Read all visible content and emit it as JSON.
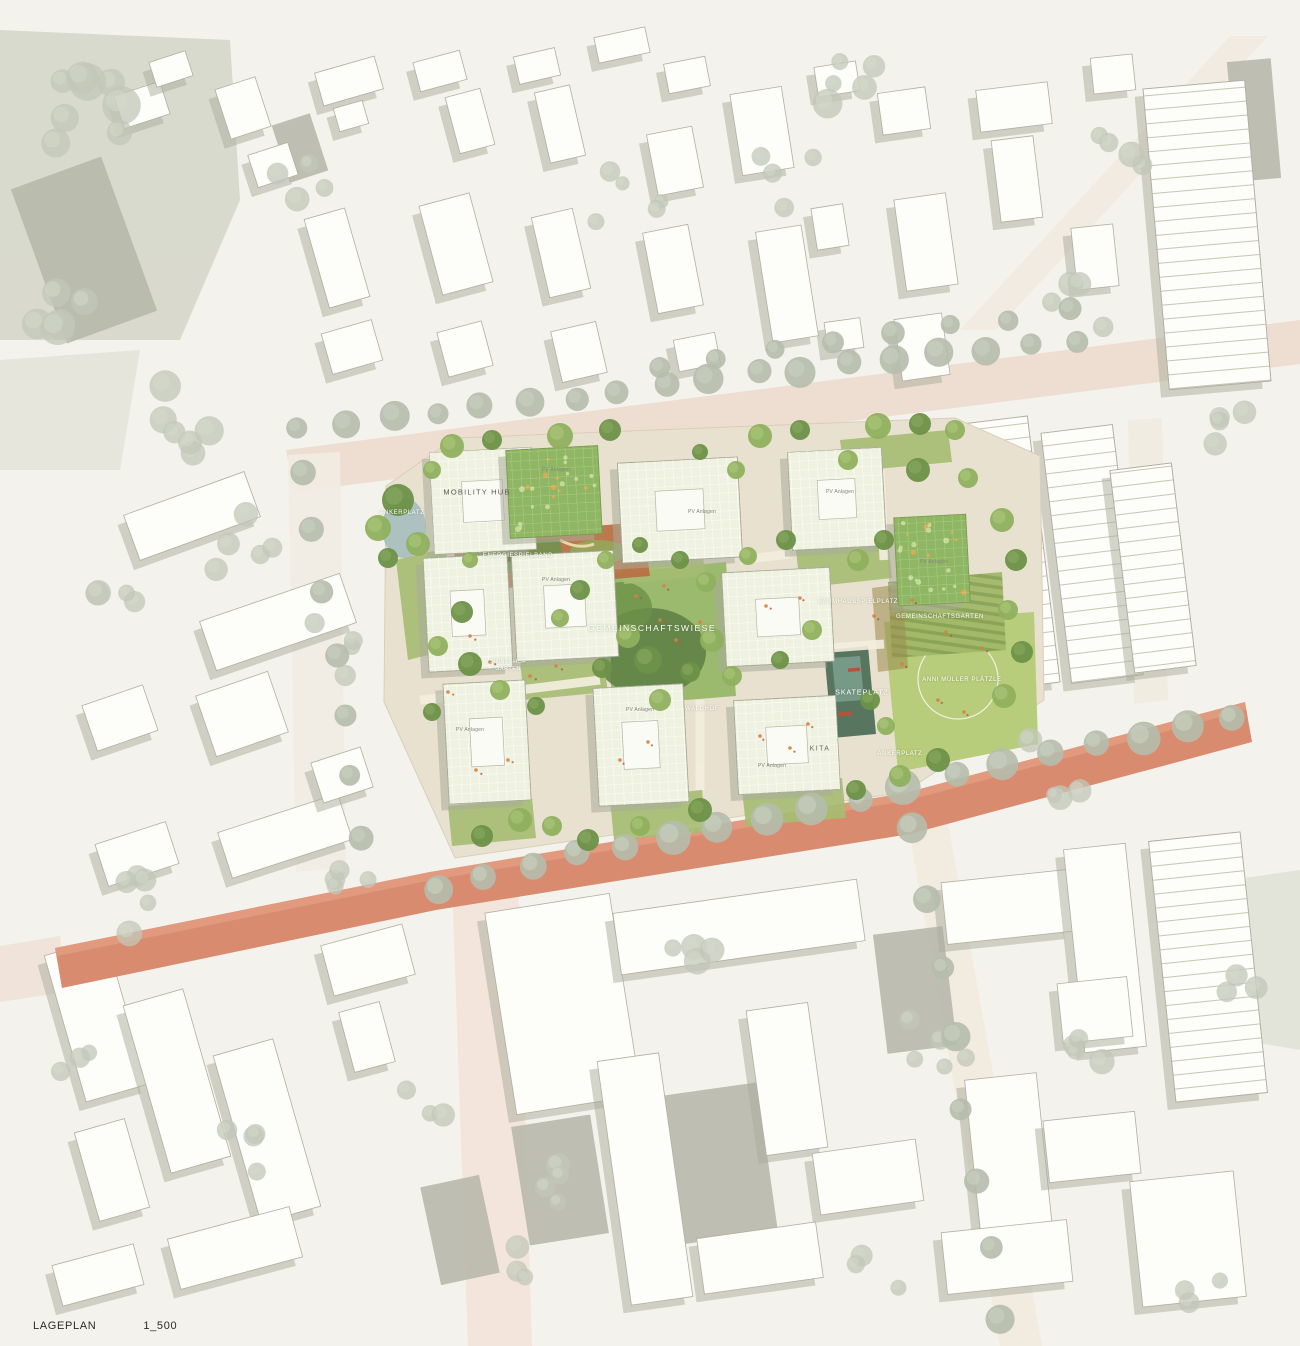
{
  "meta": {
    "title_label": "LAGEPLAN",
    "scale_label": "1_500"
  },
  "colors": {
    "background": "#f4f2ec",
    "context_building": "#fdfdf9",
    "context_shadow": "#a9ab9b",
    "main_street_salmon": "#d98b6f",
    "top_road_pink": "#ecd9cc",
    "site_base_tan": "#e9e1cf",
    "meadow_green": "#9cba6e",
    "lawn_green": "#b7cd7b",
    "dark_grove_green": "#5e7f46",
    "pv_roof_green": "#eff2e1",
    "garden_roof_green": "#8fb763",
    "play_band_orange": "#b96f42",
    "skate_teal": "#57755f",
    "label_white": "#ffffff",
    "caption_black": "#2b2b28"
  },
  "site_labels": [
    {
      "name": "label-ankerplatz-west",
      "text": "ANKERPLATZ",
      "x": 402,
      "y": 513,
      "variant": "small"
    },
    {
      "name": "label-mobility-hub",
      "text": "MOBILITY HUB",
      "x": 477,
      "y": 492,
      "variant": "dark"
    },
    {
      "name": "label-energiespielband",
      "text": "ENERGIESPIELBAND",
      "x": 518,
      "y": 556,
      "variant": "small"
    },
    {
      "name": "label-sinneshof-garten",
      "text": "SINNESHOF GARTEN",
      "x": 508,
      "y": 666,
      "variant": "tiny"
    },
    {
      "name": "label-gemeinschaftswiese",
      "text": "GEMEINSCHAFTSWIESE",
      "x": 652,
      "y": 628,
      "variant": "big"
    },
    {
      "name": "label-baumhausspielplatz",
      "text": "BAUMHAUSSPIELPLATZ",
      "x": 858,
      "y": 602,
      "variant": "small"
    },
    {
      "name": "label-gemeinschaftsgarten",
      "text": "GEMEINSCHAFTSGARTEN",
      "x": 940,
      "y": 617,
      "variant": "small"
    },
    {
      "name": "label-skateplatz",
      "text": "SKATEPLATZ",
      "x": 862,
      "y": 693,
      "variant": ""
    },
    {
      "name": "label-anni-mueller-plaetzle",
      "text": "ANNI MÜLLER PLÄTZLE",
      "x": 962,
      "y": 680,
      "variant": "small"
    },
    {
      "name": "label-waldhof",
      "text": "WALDHOF",
      "x": 702,
      "y": 709,
      "variant": "small"
    },
    {
      "name": "label-kita",
      "text": "KITA",
      "x": 820,
      "y": 749,
      "variant": "kita"
    },
    {
      "name": "label-ankerplatz-sued",
      "text": "ANKERPLATZ",
      "x": 900,
      "y": 754,
      "variant": "small"
    }
  ],
  "roof_label": {
    "text": "PV Anlagen",
    "positions": [
      {
        "x": 556,
        "y": 580
      },
      {
        "x": 702,
        "y": 512
      },
      {
        "x": 840,
        "y": 492
      },
      {
        "x": 934,
        "y": 562
      },
      {
        "x": 470,
        "y": 730
      },
      {
        "x": 640,
        "y": 710
      },
      {
        "x": 772,
        "y": 766
      },
      {
        "x": 556,
        "y": 470
      }
    ]
  },
  "icons": [
    {
      "name": "bike-icon",
      "x": 695,
      "y": 826
    }
  ]
}
